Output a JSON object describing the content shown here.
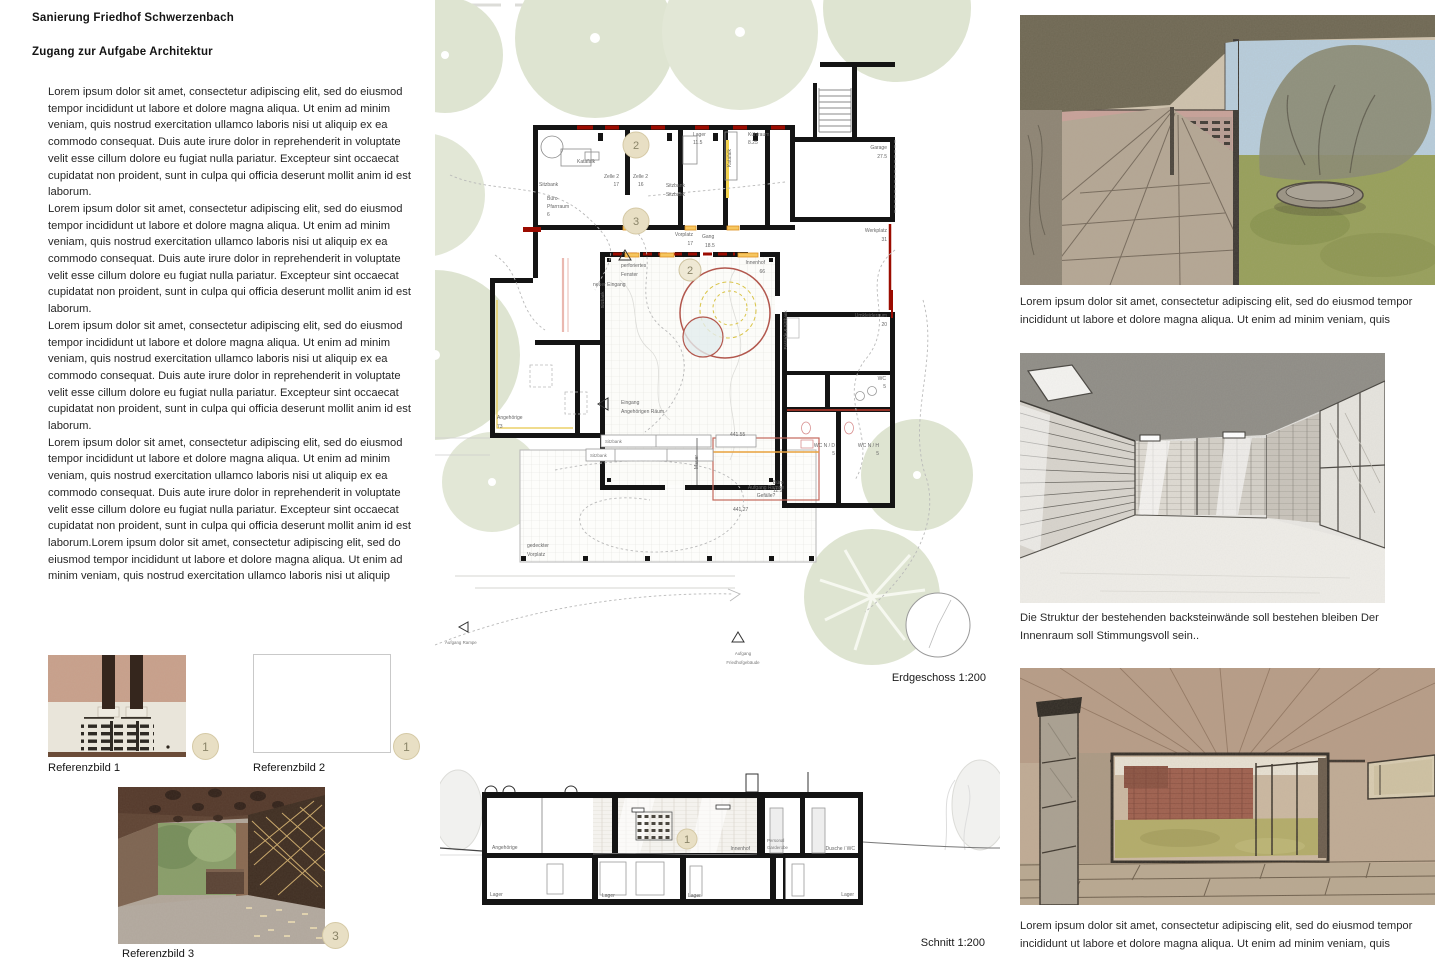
{
  "header": {
    "title": "Sanierung Friedhof Schwerzenbach",
    "subtitle": "Zugang zur Aufgabe Architektur"
  },
  "left_text": {
    "paragraphs": [
      "Lorem ipsum dolor sit amet, consectetur adipiscing elit, sed do eiusmod tempor incididunt ut labore et dolore magna aliqua. Ut enim ad minim veniam, quis nostrud exercitation ullamco laboris nisi ut aliquip ex ea commodo consequat. Duis aute irure dolor in reprehenderit in voluptate velit esse cillum dolore eu fugiat nulla pariatur. Excepteur sint occaecat cupidatat non proident, sunt in culpa qui officia deserunt mollit anim id est laborum.",
      "Lorem ipsum dolor sit amet, consectetur adipiscing elit, sed do eiusmod tempor incididunt ut labore et dolore magna aliqua. Ut enim ad minim veniam, quis nostrud exercitation ullamco laboris nisi ut aliquip ex ea commodo consequat. Duis aute irure dolor in reprehenderit in voluptate velit esse cillum dolore eu fugiat nulla pariatur. Excepteur sint occaecat cupidatat non proident, sunt in culpa qui officia deserunt mollit anim id est laborum.",
      "Lorem ipsum dolor sit amet, consectetur adipiscing elit, sed do eiusmod tempor incididunt ut labore et dolore magna aliqua. Ut enim ad minim veniam, quis nostrud exercitation ullamco laboris nisi ut aliquip ex ea commodo consequat. Duis aute irure dolor in reprehenderit in voluptate velit esse cillum dolore eu fugiat nulla pariatur. Excepteur sint occaecat cupidatat non proident, sunt in culpa qui officia deserunt mollit anim id est laborum.",
      "Lorem ipsum dolor sit amet, consectetur adipiscing elit, sed do eiusmod tempor incididunt ut labore et dolore magna aliqua. Ut enim ad minim veniam, quis nostrud exercitation ullamco laboris nisi ut aliquip ex ea commodo consequat. Duis aute irure dolor in reprehenderit in voluptate velit esse cillum dolore eu fugiat nulla pariatur. Excepteur sint occaecat cupidatat non proident, sunt in culpa qui officia deserunt mollit anim id est laborum.Lorem ipsum dolor sit amet, consectetur adipiscing elit, sed do eiusmod tempor incididunt ut labore et dolore magna aliqua. Ut enim ad minim veniam, quis nostrud exercitation ullamco laboris nisi ut aliquip"
    ]
  },
  "references": {
    "items": [
      {
        "label": "Referenzbild 1",
        "badge": "1"
      },
      {
        "label": "Referenzbild 2",
        "badge": "1"
      },
      {
        "label": "Referenzbild 3",
        "badge": "3"
      }
    ]
  },
  "plan": {
    "caption": "Erdgeschoss 1:200",
    "badge_top": "2",
    "badge_mid": "3",
    "badge_court": "2",
    "labels": {
      "katafalk": "Katafalk",
      "sitzbank": "Sitzbank",
      "zelle2": "Zelle 2",
      "n17": "17",
      "n16": "16",
      "lager": "Lager",
      "n115": "11.5",
      "kuehlraum": "Kühlraum",
      "n825": "8.25",
      "garage": "Garage",
      "n275": "27.5",
      "werkplatz": "Werkplatz",
      "n31": "31",
      "buero": "Büro",
      "pfarrraum": "Pfarrraum",
      "n6": "6",
      "vorplatz": "Vorplatz",
      "gang": "Gang",
      "n185": "18.5",
      "perforiertes": "perforiertes",
      "fenster": "Fenster",
      "neuer_eingang": "neuer Eingang",
      "innenhof": "Innenhof",
      "n66": "66",
      "umkleideraum": "Umkleideraum",
      "n20": "20",
      "wc": "WC",
      "n5": "5",
      "wc_nd": "WC N / D",
      "wc_nh": "WC N / H",
      "eingang": "Eingang",
      "angeh_raum": "Angehörigen Räum.",
      "angehoerige": "Angehörige",
      "n73": "73",
      "h44155": "441.55",
      "h44127": "441.27",
      "mauer": "Mauer",
      "aufgang_rampe": "Aufgang Rampe",
      "gefaelle": "Gefälle?",
      "gedeckter": "gedeckter",
      "vorplatz2": "Vorplatz",
      "aufgang": "Aufgang",
      "friedhofgebaeude": "Friedhofgebäude",
      "fassade_sitzbank": "Fassade & Sitzbank"
    }
  },
  "section": {
    "caption": "Schnitt 1:200",
    "badge": "1",
    "labels": {
      "angehoerige": "Angehörige",
      "innenhof": "Innenhof",
      "personal": "Personal",
      "garderobe": "Garderobe",
      "dusche_wc": "Dusche / WC",
      "lager": "Lager"
    }
  },
  "right_column": {
    "caption_top": "Lorem ipsum dolor sit amet, consectetur adipiscing elit, sed do eiusmod tempor incididunt ut labore et dolore magna aliqua. Ut enim ad minim veniam, quis",
    "caption_mid": "Die Struktur der bestehenden backsteinwände soll bestehen bleiben Der Innenraum soll Stimmungsvoll sein..",
    "caption_bottom": "Lorem ipsum dolor sit amet, consectetur adipiscing elit, sed do eiusmod tempor incididunt ut labore et dolore magna aliqua. Ut enim ad minim veniam, quis"
  },
  "colors": {
    "sage": "#dee4d1",
    "badge_bg": "#e8dfc4",
    "accent_red": "#9b0b00",
    "tree_red": "#b2574d",
    "bench_orange": "#f6c65f"
  }
}
